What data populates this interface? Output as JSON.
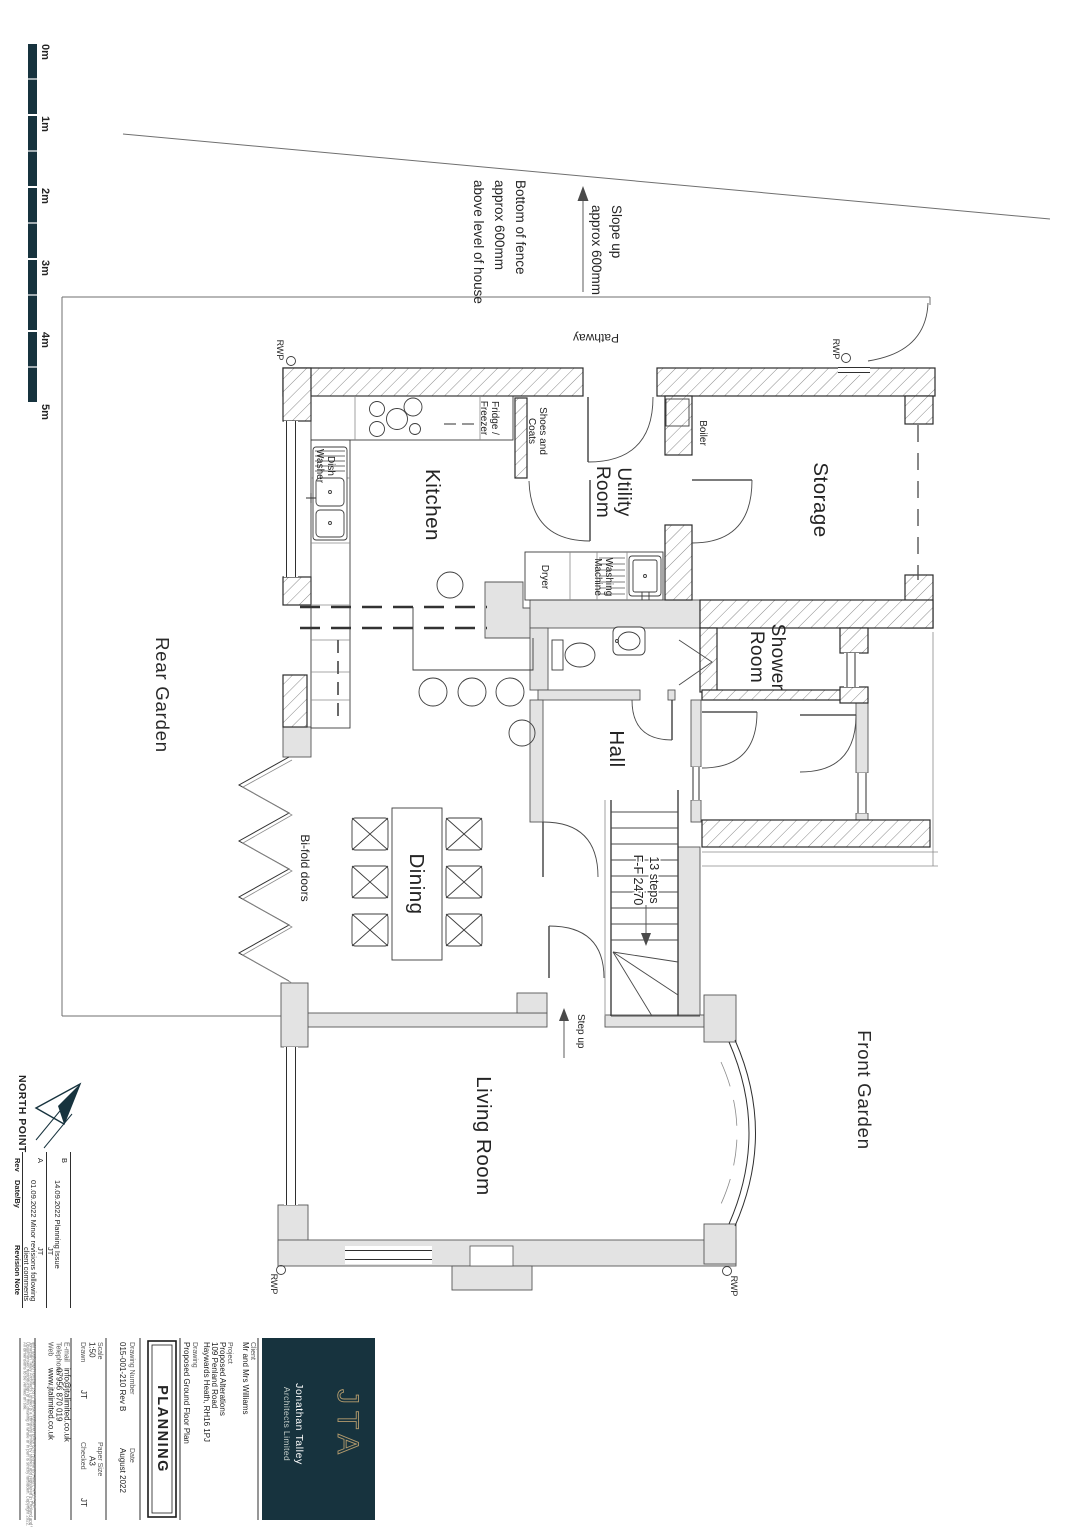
{
  "site": {
    "scale_labels": [
      "0m",
      "1m",
      "2m",
      "3m",
      "4m",
      "5m"
    ],
    "fence_note": [
      "Bottom of fence",
      "approx 600mm",
      "above level of house"
    ],
    "slope_note": [
      "Slope up",
      "approx 600mm"
    ],
    "pathway": "Pathway",
    "rear_garden": "Rear Garden",
    "front_garden": "Front Garden",
    "rwp": "RWP"
  },
  "rooms": {
    "kitchen": "Kitchen",
    "utility": [
      "Utility",
      "Room"
    ],
    "storage": "Storage",
    "shower": [
      "Shower",
      "Room"
    ],
    "hall": "Hall",
    "dining": "Dining",
    "living": "Living Room"
  },
  "fixtures": {
    "fridge": [
      "Fridge /",
      "Freezer"
    ],
    "shoes": [
      "Shoes and",
      "Coats"
    ],
    "boiler": "Boiler",
    "dryer": "Dryer",
    "washing": [
      "Washing",
      "Machine"
    ],
    "dish": [
      "Dish",
      "Washer"
    ],
    "bifold": "Bi-fold doors",
    "stairs": [
      "13 steps",
      "F-F 2470"
    ],
    "step_up": "Step up"
  },
  "north_point": {
    "label": "NORTH POINT"
  },
  "revisions": {
    "headers": {
      "rev": "Rev",
      "date_by": "Date/By",
      "note": "Revision Note"
    },
    "rows": [
      {
        "rev": "B",
        "line1": "14.09.2022 Planning Issue",
        "by": "JT"
      },
      {
        "rev": "A",
        "line1": "01.09.2022 Minor revisions following",
        "line2": "client comments",
        "by": "JT"
      }
    ]
  },
  "title_block": {
    "client_label": "Client",
    "client": "Mr and Mrs Williams",
    "project_label": "Project",
    "project_lines": [
      "Proposed Alterations",
      "109 Penland Road",
      "Haywards Heath, RH16 1PJ"
    ],
    "drawing_label": "Drawing",
    "drawing": "Proposed Ground Floor Plan",
    "status": "PLANNING",
    "drawing_number_label": "Drawing Number",
    "drawing_number": "015-001-210 Rev B",
    "date_label": "Date",
    "date": "August 2022",
    "scale_label": "Scale",
    "scale": "1:50",
    "paper_label": "Paper Size",
    "paper": "A3",
    "drawn_label": "Drawn",
    "drawn": "JT",
    "checked_label": "Checked",
    "checked": "JT",
    "email_label": "E-mail",
    "email": "info@jtalimited.co.uk",
    "telephone_label": "Telephone",
    "telephone": "07956 870 019",
    "web_label": "Web",
    "web": "www.jtalimited.co.uk",
    "small_print": [
      "All dimensions to be verified on site.",
      "Unauthorised reproduction of this drawing in whole or in part is strictly forbidden. Copyright 2022.",
      "Jonathan Talley Architects Limited is a company limited by shares and registered in England and Wales",
      "with registered number 13572 whose registered office is in Haywards Heath, RH17 5LF."
    ]
  },
  "logo": {
    "monogram": "JTA",
    "name": "Jonathan Talley",
    "sub": "Architects Limited"
  },
  "colors": {
    "brand_teal": "#17333e",
    "brand_gold": "#b39b6d",
    "wall_existing": "#e3e3e3",
    "line": "#2f2f2f"
  }
}
